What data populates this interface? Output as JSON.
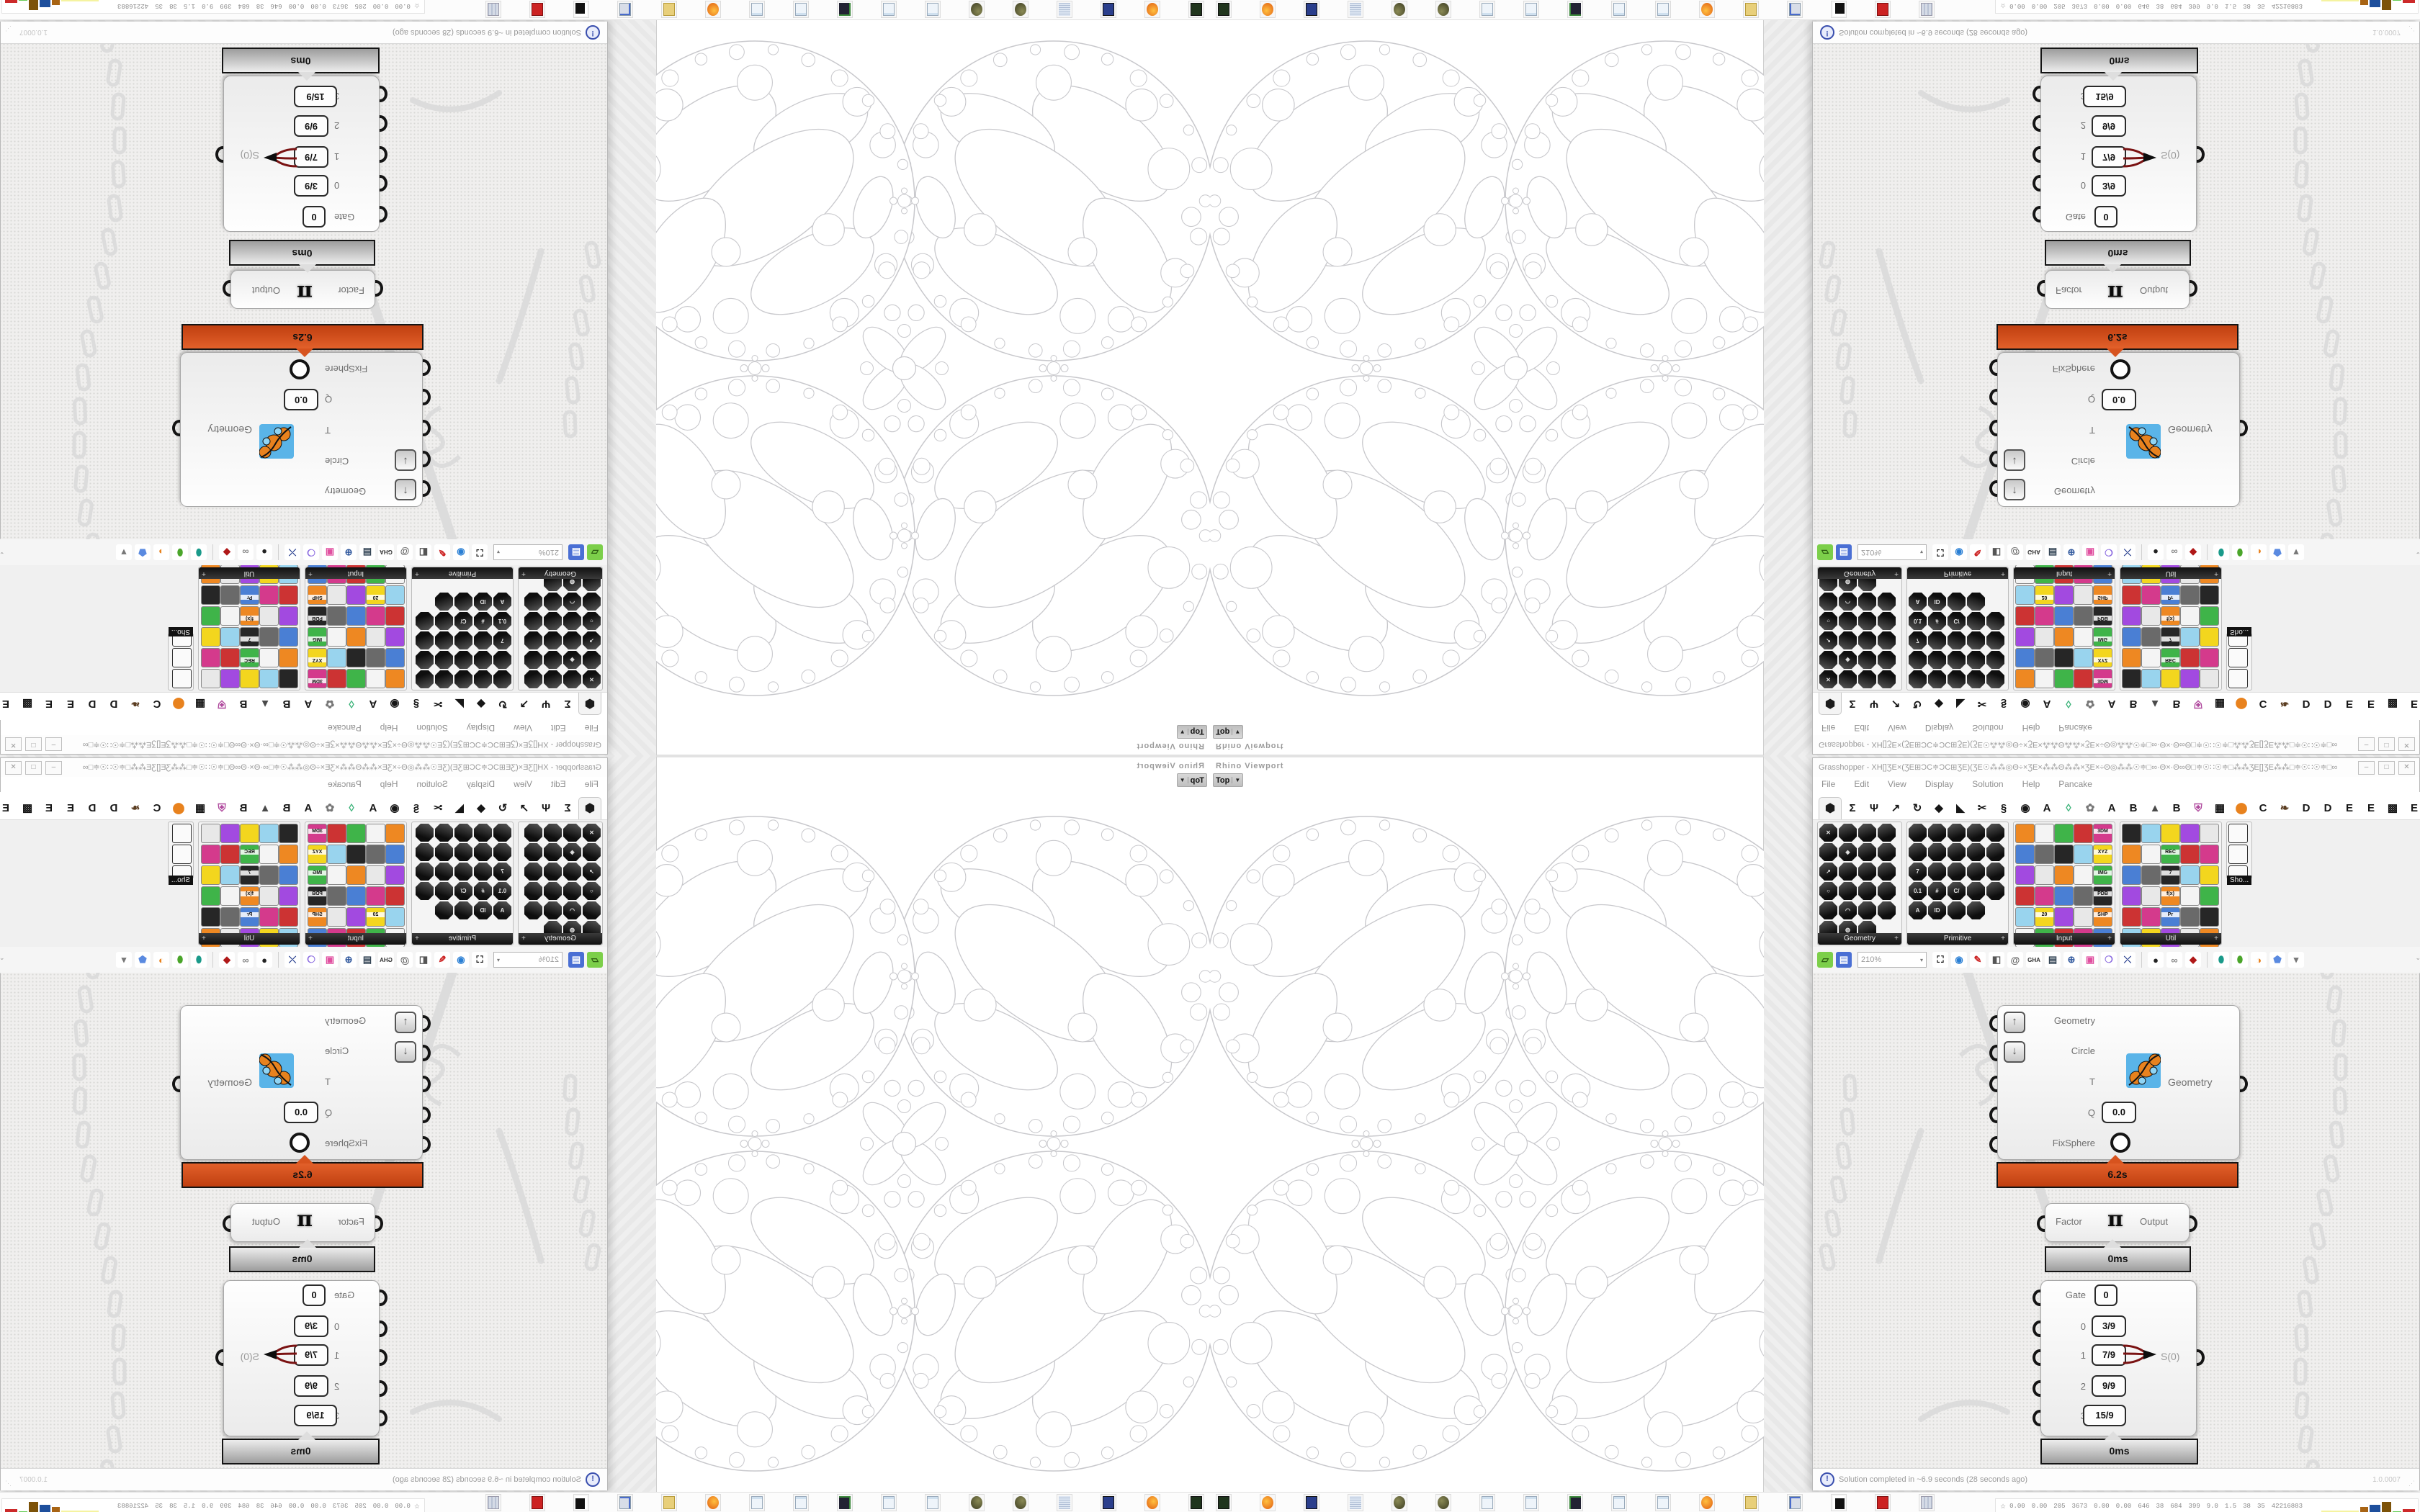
{
  "window": {
    "title": "Grasshopper - XH[]ƷE×(ƷE⊞ƆC≑ƆC⊞ƷE)(ƷE☉⁂⁂◎Θ÷×ƷE×⁂⁂Θ⁂⁂×ƷE×÷Θ◎⁂⁂☉≑□∞·Θ×·Θ∞Θ□≑☉∷☉≑□⁂⁂ƷE[]ƷE⁂⁂□≑☉∷☉≑□∞·Θ×·Θ∞□≑☉⁂⁂◎Θ÷×ƷE×⁂⁂Θ⁂⁂…",
    "minimize_label": "–",
    "maximize_label": "□",
    "close_label": "✕"
  },
  "menu": {
    "items": [
      "File",
      "Edit",
      "View",
      "Display",
      "Solution",
      "Help",
      "Pancake"
    ]
  },
  "tabs": {
    "selected_glyph": "⬢",
    "items": [
      {
        "g": "Σ",
        "c": "#161616"
      },
      {
        "g": "Ψ",
        "c": "#161616"
      },
      {
        "g": "↗",
        "c": "#161616"
      },
      {
        "g": "↻",
        "c": "#161616"
      },
      {
        "g": "◆",
        "c": "#161616"
      },
      {
        "g": "◣",
        "c": "#161616"
      },
      {
        "g": "✂",
        "c": "#161616"
      },
      {
        "g": "§",
        "c": "#161616"
      },
      {
        "g": "◉",
        "c": "#161616"
      },
      {
        "g": "A",
        "c": "#161616"
      },
      {
        "g": "◊",
        "c": "#3db37a"
      },
      {
        "g": "✿",
        "c": "#777"
      },
      {
        "g": "A",
        "c": "#161616"
      },
      {
        "g": "B",
        "c": "#161616"
      },
      {
        "g": "▲",
        "c": "#4a4a4a"
      },
      {
        "g": "B",
        "c": "#161616"
      },
      {
        "g": "⛨",
        "c": "#b04a9e"
      },
      {
        "g": "▦",
        "c": "#161616"
      },
      {
        "g": "⬤",
        "c": "#e8821e"
      },
      {
        "g": "C",
        "c": "#161616"
      },
      {
        "g": "❧",
        "c": "#5a3c20"
      },
      {
        "g": "D",
        "c": "#161616"
      },
      {
        "g": "D",
        "c": "#161616"
      },
      {
        "g": "E",
        "c": "#161616"
      },
      {
        "g": "E",
        "c": "#161616"
      },
      {
        "g": "▩",
        "c": "#161616"
      },
      {
        "g": "E",
        "c": "#161616"
      }
    ]
  },
  "palette": {
    "panels": [
      {
        "label": "Geometry",
        "style": "dark",
        "cols": 4,
        "count": 23,
        "width": 116,
        "glyphs": {
          "0": "✕",
          "5": "◈",
          "8": "↗",
          "12": "○",
          "17": "◠",
          "21": "◍"
        }
      },
      {
        "label": "Primitive",
        "style": "dark",
        "cols": 5,
        "count": 24,
        "width": 140,
        "glyphs": {
          "10": "7",
          "15": "0.1",
          "16": "#",
          "17": "C/",
          "20": "A",
          "21": "ID"
        }
      },
      {
        "label": "Input",
        "style": "color",
        "cols": 5,
        "count": 30,
        "width": 140,
        "badges": {
          "4": "3DM",
          "9": "XYZ",
          "14": "IMG",
          "19": "PDB",
          "24": "SHP",
          "21": "20",
          "29": "ID."
        }
      },
      {
        "label": "Util",
        "style": "color",
        "cols": 5,
        "count": 30,
        "width": 140,
        "badges": {
          "7": "REC",
          "12": "7",
          "17": "f(x)",
          "22": "Pr",
          "27": "X…"
        }
      },
      {
        "label": "Sho...",
        "style": "mini",
        "cols": 1,
        "count": 3,
        "width": 34
      }
    ],
    "color_cycle": [
      "#e8e8e8",
      "#d43a8c",
      "#f3d61e",
      "#3fb449",
      "#262626",
      "#ee8822",
      "#4a7fd4",
      "#a24ae0",
      "#cc3333",
      "#99d4ee",
      "#f4f4f4",
      "#6a6a6a"
    ]
  },
  "toolbar": {
    "zoom_value": "210%",
    "items": [
      {
        "name": "open-file-button",
        "g": "▱",
        "bg": "#7ccf4a",
        "fg": "#2a5a10"
      },
      {
        "name": "save-file-button",
        "g": "▤",
        "bg": "#4a6fd4",
        "fg": "#fff"
      },
      {
        "name": "zoom-extents-button",
        "g": "⛶",
        "bg": "#fff",
        "fg": "#111"
      },
      {
        "name": "preview-eye-button",
        "g": "◉",
        "bg": "#fff",
        "fg": "#2a7fd4"
      },
      {
        "name": "sketch-pen-button",
        "g": "✎",
        "bg": "#fff",
        "fg": "#c22"
      },
      {
        "name": "exposure-button",
        "g": "◧",
        "bg": "#fff",
        "fg": "#555"
      },
      {
        "name": "at-button",
        "g": "@",
        "bg": "#fff",
        "fg": "#666"
      },
      {
        "name": "gha-button",
        "g": "GHA",
        "bg": "#fff",
        "fg": "#333"
      },
      {
        "name": "find-document-button",
        "g": "▤",
        "bg": "#fff",
        "fg": "#345"
      },
      {
        "name": "magnifier-button",
        "g": "⊕",
        "bg": "#fff",
        "fg": "#335a9e"
      },
      {
        "name": "package-button",
        "g": "▣",
        "bg": "#fff",
        "fg": "#e050a0"
      },
      {
        "name": "balloon-button",
        "g": "❍",
        "bg": "#fff",
        "fg": "#8a6ae0"
      },
      {
        "name": "wires-button",
        "g": "⤬",
        "bg": "#fff",
        "fg": "#223a8c"
      },
      {
        "name": "sep",
        "g": "",
        "bg": "",
        "fg": ""
      },
      {
        "name": "cluster-ball-button",
        "g": "●",
        "bg": "#fff",
        "fg": "#222"
      },
      {
        "name": "cluster-rings-button",
        "g": "∞",
        "bg": "#fff",
        "fg": "#888"
      },
      {
        "name": "cluster-gem-button",
        "g": "◆",
        "bg": "#fff",
        "fg": "#b01818"
      },
      {
        "name": "sep",
        "g": "",
        "bg": "",
        "fg": ""
      },
      {
        "name": "bake-teal-button",
        "g": "⬮",
        "bg": "#fff",
        "fg": "#1a9a8a"
      },
      {
        "name": "bake-green-button",
        "g": "⬮",
        "bg": "#fff",
        "fg": "#4aa52a"
      },
      {
        "name": "preview-half-button",
        "g": "◑",
        "bg": "#fff",
        "fg": "#e8821e"
      },
      {
        "name": "preview-blue-button",
        "g": "⬟",
        "bg": "#fff",
        "fg": "#5a8ae0"
      },
      {
        "name": "dropdown",
        "g": "▾",
        "bg": "#fff",
        "fg": "#777"
      }
    ],
    "collapse_label": "⌄"
  },
  "viewport": {
    "label": "Rhino Viewport",
    "tab": "Top",
    "tab_arrow": "▼"
  },
  "components": {
    "fixsphere": {
      "inputs": [
        "Geometry",
        "Circle",
        "T",
        "Q",
        "FixSphere"
      ],
      "q_value": "0.0",
      "output": "Geometry",
      "time": "6.2s"
    },
    "factor": {
      "input": "Factor",
      "icon": "π",
      "output": "Output",
      "time": "0ms"
    },
    "gate": {
      "gate_label": "Gate",
      "gate_value": "0",
      "rows": [
        {
          "index": "0",
          "value": "3/9"
        },
        {
          "index": "1",
          "value": "7/9"
        },
        {
          "index": "2",
          "value": "9/9"
        },
        {
          "index": "3",
          "value": "15/9"
        }
      ],
      "output": "S(0)",
      "time": "0ms"
    }
  },
  "statusbar": {
    "icon": "!",
    "message": "Solution completed in ~6.9 seconds (28 seconds ago)",
    "version": "1.0.0007",
    "grip": "⋰"
  },
  "taskbar": {
    "icons": [
      "device",
      "firefox",
      "floppy",
      "scroll",
      "ball",
      "ball",
      "note",
      "note",
      "monitor",
      "note",
      "note",
      "firefox",
      "folder",
      "pc",
      "zigzag",
      "redcard",
      "calc"
    ]
  },
  "stats": {
    "star": "☆",
    "values": [
      "0.00",
      "0.00",
      "205",
      "3673",
      "0.00",
      "0.00",
      "646",
      "38",
      "684",
      "399",
      "9.0",
      "1.5",
      "38",
      "35",
      "42216883"
    ],
    "bars": [
      {
        "w": 52,
        "h": 3,
        "c": "#f5f3a0"
      },
      {
        "w": 11,
        "h": 8,
        "c": "#a86414"
      },
      {
        "w": 15,
        "h": 11,
        "c": "#1e4f9c"
      },
      {
        "w": 13,
        "h": 15,
        "c": "#7c5208"
      },
      {
        "w": 12,
        "h": 2,
        "c": "#66cc55"
      },
      {
        "w": 17,
        "h": 5,
        "c": "#cc2a2a"
      }
    ]
  },
  "colors": {
    "accent_hot": "#d7531e",
    "fractal_stroke": "#c8c8cc",
    "doodle": "#dcdcdc",
    "icon_blue": "#5ab4e8",
    "icon_orange": "#e8821e"
  },
  "fractal": {
    "center": [
      424.5,
      514.5
    ],
    "lobe_radius": 222,
    "lobe_centers": [
      [
        217,
        282
      ],
      [
        632,
        282
      ],
      [
        217,
        747
      ],
      [
        632,
        747
      ]
    ],
    "lobe_ellipses": [
      [
        -0.3,
        -0.36,
        0.5,
        0.26,
        -36
      ],
      [
        0.35,
        -0.44,
        0.38,
        0.19,
        -24
      ],
      [
        0.1,
        -0.02,
        0.6,
        0.3,
        -36
      ],
      [
        -0.46,
        0.34,
        0.4,
        0.21,
        -58
      ],
      [
        0.36,
        0.44,
        0.42,
        0.21,
        -28
      ],
      [
        0.74,
        0.04,
        0.2,
        0.11,
        -70
      ]
    ],
    "lobe_circles": [
      [
        -0.72,
        -0.2,
        0.13
      ],
      [
        -0.55,
        -0.6,
        0.1
      ],
      [
        0.0,
        -0.74,
        0.11
      ],
      [
        0.64,
        -0.62,
        0.09
      ],
      [
        0.8,
        -0.35,
        0.08
      ],
      [
        -0.15,
        0.72,
        0.11
      ],
      [
        -0.76,
        0.45,
        0.09
      ],
      [
        -0.42,
        0.74,
        0.08
      ],
      [
        0.56,
        0.7,
        0.09
      ],
      [
        0.82,
        0.4,
        0.07
      ],
      [
        -0.86,
        0.1,
        0.06
      ],
      [
        0.46,
        0.18,
        0.1
      ],
      [
        -0.18,
        0.32,
        0.09
      ],
      [
        0.86,
        0.7,
        0.05
      ]
    ],
    "mid_clusters": [
      [
        424.5,
        282
      ],
      [
        424.5,
        747
      ],
      [
        217,
        514.5
      ],
      [
        632,
        514.5
      ]
    ]
  }
}
